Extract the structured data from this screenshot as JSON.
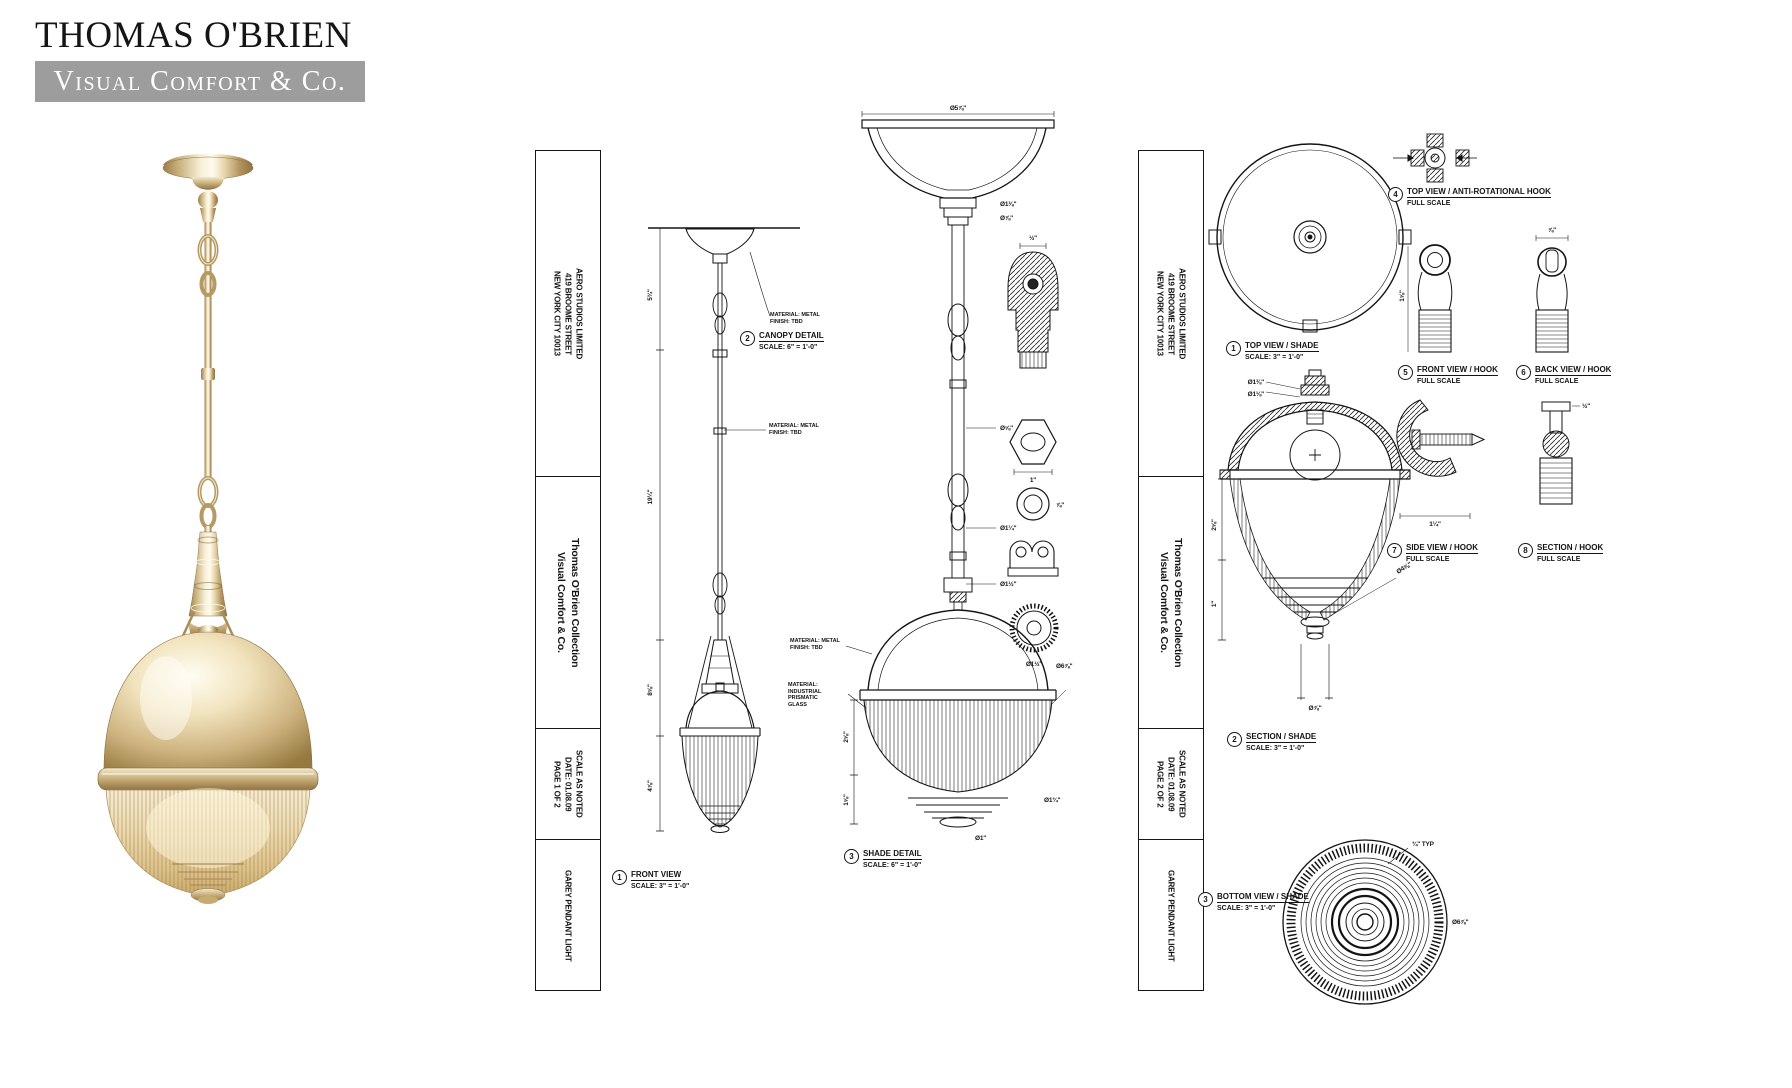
{
  "logo": {
    "name": "THOMAS O'BRIEN",
    "tagline": "Visual Comfort & Co."
  },
  "colors": {
    "banner_gray": "#9d9d9d",
    "drawing_line": "#141414",
    "metal_tone": "#d9c193"
  },
  "sheet1": {
    "title_block": {
      "company": "AERO STUDIOS LIMITED",
      "address": "419 BROOME STREET",
      "city": "NEW YORK CITY 10013",
      "collection": "Thomas O'Brien Collection",
      "brand": "Visual Comfort & Co.",
      "scale": "SCALE AS NOTED",
      "date": "DATE: 01.08.09",
      "page": "PAGE 1 OF 2",
      "product": "GAREY PENDANT LIGHT"
    },
    "views": [
      {
        "num": "1",
        "title": "FRONT VIEW",
        "scale": "SCALE: 3\" = 1'-0\""
      },
      {
        "num": "2",
        "title": "CANOPY DETAIL",
        "scale": "SCALE: 6\" = 1'-0\""
      },
      {
        "num": "3",
        "title": "SHADE DETAIL",
        "scale": "SCALE: 6\" = 1'-0\""
      }
    ],
    "notes": [
      {
        "l1": "MATERIAL: METAL",
        "l2": "FINISH: TBD"
      },
      {
        "l1": "MATERIAL: METAL",
        "l2": "FINISH: TBD"
      },
      {
        "l1": "MATERIAL: METAL",
        "l2": "FINISH: TBD"
      },
      {
        "l1": "MATERIAL:",
        "l2": "INDUSTRIAL",
        "l3": "PRISMATIC",
        "l4": "GLASS"
      }
    ],
    "dims": {
      "front": [
        "5¾\"",
        "19¼\"",
        "8⅝\"",
        "4⅞\""
      ],
      "canopy": [
        "Ø5⅞\"",
        "Ø1⅜\"",
        "Ø⅞\"",
        "Ø⅝\"",
        "Ø1¼\"",
        "Ø1½\""
      ],
      "shade": [
        "Ø6⅞\"",
        "2⅝\"",
        "1⅝\"",
        "Ø1¾\"",
        "Ø1\""
      ],
      "parts": [
        "½\"",
        "1\"",
        "⅞\"",
        "Ø1½\""
      ]
    }
  },
  "sheet2": {
    "title_block": {
      "company": "AERO STUDIOS LIMITED",
      "address": "419 BROOME STREET",
      "city": "NEW YORK CITY 10013",
      "collection": "Thomas O'Brien Collection",
      "brand": "Visual Comfort & Co.",
      "scale": "SCALE AS NOTED",
      "date": "DATE: 01.08.09",
      "page": "PAGE 2 OF 2",
      "product": "GAREY PENDANT LIGHT"
    },
    "views": [
      {
        "num": "1",
        "title": "TOP VIEW / SHADE",
        "scale": "SCALE: 3\" = 1'-0\""
      },
      {
        "num": "2",
        "title": "SECTION / SHADE",
        "scale": "SCALE: 3\" = 1'-0\""
      },
      {
        "num": "3",
        "title": "BOTTOM VIEW / SHADE",
        "scale": "SCALE: 3\" = 1'-0\""
      },
      {
        "num": "4",
        "title": "TOP VIEW / ANTI-ROTATIONAL HOOK",
        "scale": "FULL SCALE"
      },
      {
        "num": "5",
        "title": "FRONT VIEW / HOOK",
        "scale": "FULL SCALE"
      },
      {
        "num": "6",
        "title": "BACK VIEW / HOOK",
        "scale": "FULL SCALE"
      },
      {
        "num": "7",
        "title": "SIDE VIEW / HOOK",
        "scale": "FULL SCALE"
      },
      {
        "num": "8",
        "title": "SECTION / HOOK",
        "scale": "FULL SCALE"
      }
    ],
    "dims": {
      "section": [
        "Ø1⅜\"",
        "Ø1⅛\"",
        "2⅝\"",
        "1\"",
        "Ø4⅝\"",
        "Ø⅞\""
      ],
      "bottom": [
        "¾\" TYP",
        "Ø6⅞\""
      ],
      "hooks": [
        "⅞\"",
        "1⅝\"",
        "1¼\"",
        "½\""
      ]
    }
  }
}
